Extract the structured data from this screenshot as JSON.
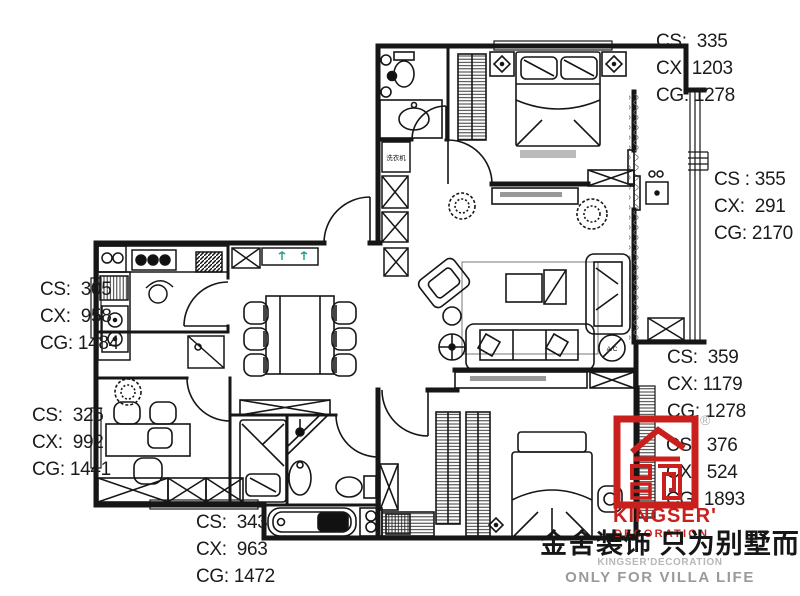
{
  "plan_texts": {
    "washing_machine": "洗衣机",
    "air_conditioner": "A/C"
  },
  "dimension_labels": [
    {
      "name": "top-right",
      "lines": [
        "CS:  335",
        "CX: 1203",
        "CG: 1278"
      ]
    },
    {
      "name": "right-upper",
      "lines": [
        "CS : 355",
        "CX:  291",
        "CG: 2170"
      ]
    },
    {
      "name": "right-middle",
      "lines": [
        "CS:  359",
        "CX: 1179",
        "CG: 1278"
      ]
    },
    {
      "name": "right-lower",
      "lines": [
        "CS:  376",
        "CX:  524",
        "CG: 1893"
      ]
    },
    {
      "name": "left-upper",
      "lines": [
        "CS:  305",
        "CX:  958",
        "CG: 1484"
      ]
    },
    {
      "name": "left-lower",
      "lines": [
        "CS:  325",
        "CX:  992",
        "CG: 1441"
      ]
    },
    {
      "name": "bottom",
      "lines": [
        "CS:  343",
        "CX:  963",
        "CG: 1472"
      ]
    }
  ],
  "brand": {
    "registered_mark": "®",
    "logo_name_line1": "KINGSER'",
    "logo_name_line2": "DECORATION",
    "slogan_cn": "金舍装饰 只为别墅而生。",
    "slogan_en_small": "KINGSER'DECORATION",
    "slogan_en_large": "ONLY FOR VILLA LIFE",
    "brand_red": "#c9201d",
    "text_gray": "#9a9a9a"
  }
}
